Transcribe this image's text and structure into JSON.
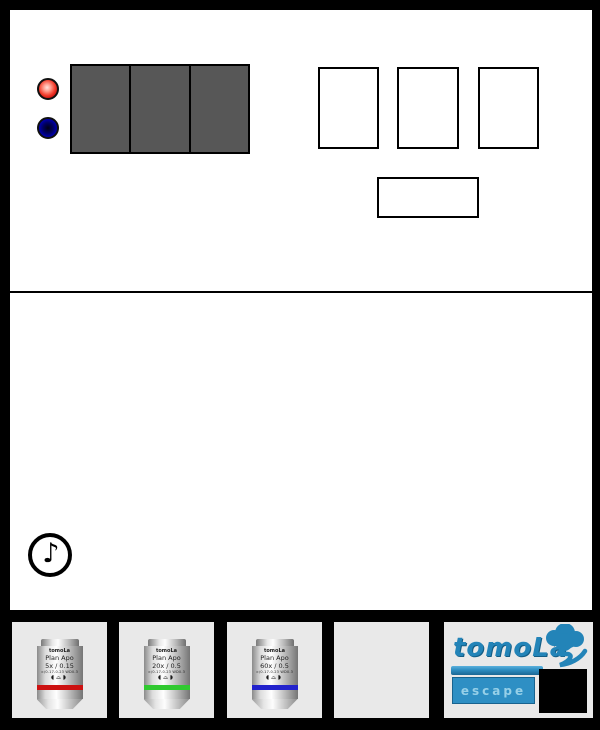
{
  "control_panel": {
    "leds": [
      {
        "name": "red-led",
        "color": "#f23c2c"
      },
      {
        "name": "blue-led",
        "color": "#000099"
      }
    ],
    "display": {
      "segment_count": 3,
      "bg_color": "#575757"
    },
    "slot_count": 3
  },
  "sound_icon": {
    "glyph": "♪"
  },
  "objectives": [
    {
      "brand": "tomoLa",
      "series": "Plan Apo",
      "magnification": "5x / 0.15",
      "spec": "∞/0.17-0.23 WD0.3",
      "symbols": "◖⌓◗",
      "band_color": "#cc1111"
    },
    {
      "brand": "tomoLa",
      "series": "Plan Apo",
      "magnification": "20x / 0.5",
      "spec": "∞/0.17-0.23 WD0.3",
      "symbols": "◖⌓◗",
      "band_color": "#30c930"
    },
    {
      "brand": "tomoLa",
      "series": "Plan Apo",
      "magnification": "60x / 0.5",
      "spec": "∞/0.17-0.23 WD0.3",
      "symbols": "◖⌓◗",
      "band_color": "#2222cc"
    }
  ],
  "logo": {
    "brand": "tomoLa",
    "button_label": "escape",
    "accent_color": "#2384b8",
    "button_bg": "#2e8fc4",
    "button_text_color": "#a9dcef"
  }
}
